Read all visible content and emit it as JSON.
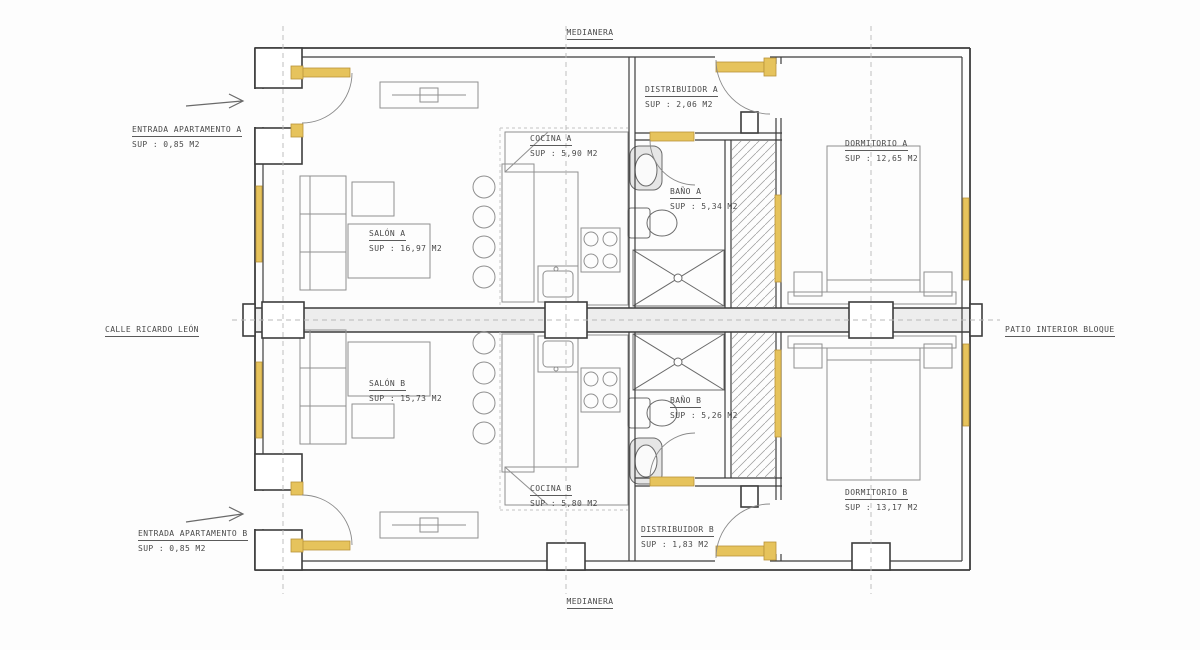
{
  "site_labels": {
    "medianera_top": "MEDIANERA",
    "medianera_bottom": "MEDIANERA",
    "street_left": "CALLE RICARDO LEÓN",
    "patio_right": "PATIO INTERIOR BLOQUE"
  },
  "entrances": {
    "a": {
      "name": "ENTRADA APARTAMENTO A",
      "sup": "SUP : 0,85 M2"
    },
    "b": {
      "name": "ENTRADA APARTAMENTO B",
      "sup": "SUP : 0,85 M2"
    }
  },
  "rooms": {
    "distribuidor_a": {
      "name": "DISTRIBUIDOR A",
      "sup": "SUP : 2,06 M2"
    },
    "cocina_a": {
      "name": "COCINA A",
      "sup": "SUP : 5,90 M2"
    },
    "bano_a": {
      "name": "BAÑO A",
      "sup": "SUP : 5,34 M2"
    },
    "dormitorio_a": {
      "name": "DORMITORIO A",
      "sup": "SUP : 12,65 M2"
    },
    "salon_a": {
      "name": "SALÓN A",
      "sup": "SUP : 16,97 M2"
    },
    "salon_b": {
      "name": "SALÓN B",
      "sup": "SUP : 15,73 M2"
    },
    "bano_b": {
      "name": "BAÑO B",
      "sup": "SUP : 5,26 M2"
    },
    "cocina_b": {
      "name": "COCINA B",
      "sup": "SUP : 5,80 M2"
    },
    "dormitorio_b": {
      "name": "DORMITORIO B",
      "sup": "SUP : 13,17 M2"
    },
    "distribuidor_b": {
      "name": "DISTRIBUIDOR B",
      "sup": "SUP : 1,83 M2"
    }
  },
  "colors": {
    "wall": "#3d3d3d",
    "carpentry_fill": "#e6c35c",
    "carpentry_edge": "#b8933a",
    "furniture": "#909090",
    "band_fill": "#ededed",
    "text": "#4a4a4a"
  }
}
